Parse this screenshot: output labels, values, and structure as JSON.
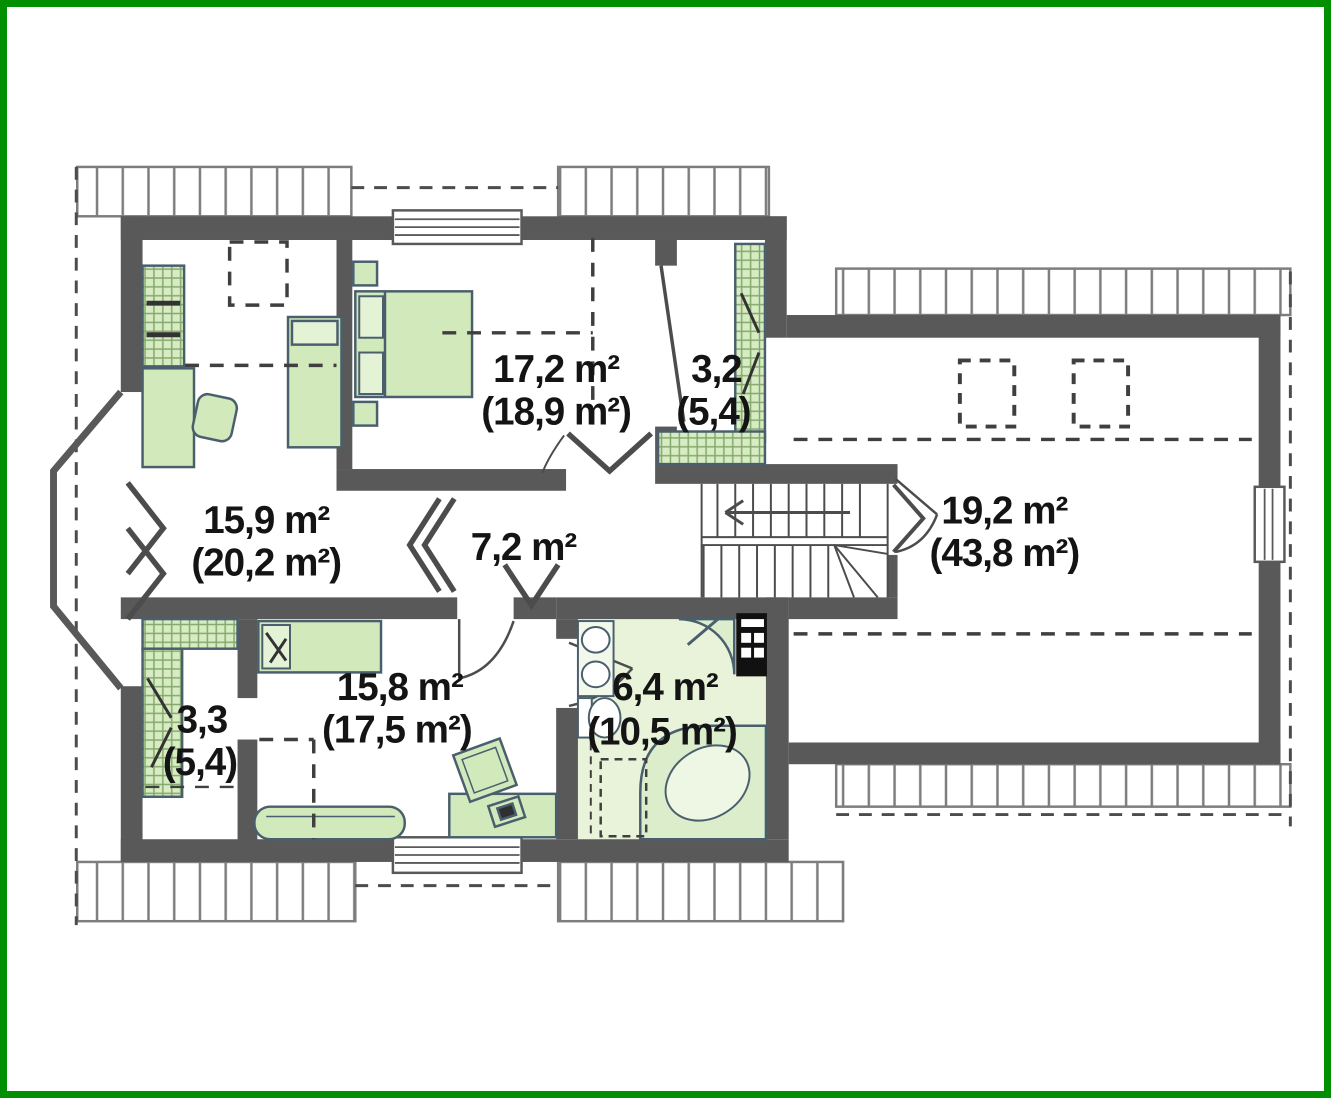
{
  "plan_title": "attic floor plan",
  "colors": {
    "frame": "#029002",
    "wall": "#595959",
    "furniture_fill": "#d2e9bb",
    "bathroom_floor": "#e8f3da",
    "hatch_line": "#85a86e",
    "eave_line": "#7d7d7d",
    "label_text": "#141414"
  },
  "rooms": {
    "bedroom_nw": {
      "area": "15,9 m²",
      "gross": "(20,2 m²)"
    },
    "bedroom_n": {
      "area": "17,2 m²",
      "gross": "(18,9 m²)"
    },
    "closet_ne": {
      "area": "3,2",
      "gross": "(5,4)"
    },
    "hall": {
      "area": "7,2 m²"
    },
    "attic_e": {
      "area": "19,2 m²",
      "gross": "(43,8 m²)"
    },
    "bedroom_s": {
      "area": "15,8 m²",
      "gross": "(17,5 m²)"
    },
    "bathroom": {
      "area": "6,4 m²",
      "gross": "(10,5 m²)"
    },
    "closet_sw": {
      "area": "3,3",
      "gross": "(5,4)"
    }
  }
}
